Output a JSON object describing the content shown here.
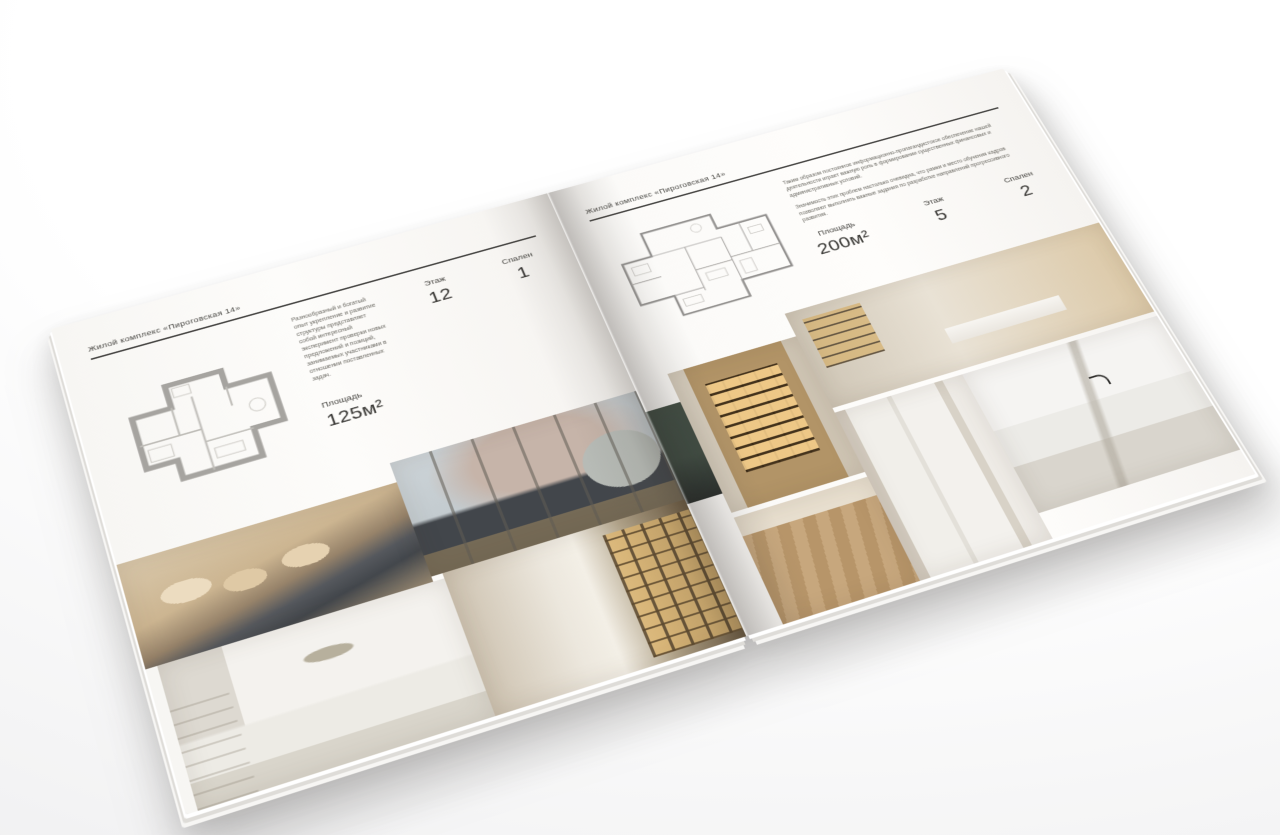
{
  "palette": {
    "page": "#fcfbf9",
    "text": "#3f3e3c",
    "rule": "#454442",
    "wood_accent": "#c2a26c"
  },
  "left_page": {
    "header": "Жилой комплекс «Пироговская 14»",
    "description": "Разнообразный и богатый опыт укрепление и развитие структуры представляет собой интересный эксперимент проверки новых предложений и позиций, занимаемых участниками в отношении поставленных задач.",
    "stats": {
      "area": {
        "label": "Площадь",
        "value": "125м²"
      },
      "floor": {
        "label": "Этаж",
        "value": "12"
      },
      "bedrooms": {
        "label": "Спален",
        "value": "1"
      }
    },
    "photos": [
      "bedroom-beige",
      "living-room-window",
      "bedroom-white",
      "hallway-shelves"
    ]
  },
  "right_page": {
    "header": "Жилой комплекс «Пироговская 14»",
    "paragraphs": [
      "Таким образом постоянное информационно-пропагандистское обеспечение нашей деятельности играет важную роль в формировании существенных финансовых и административных условий.",
      "Значимость этих проблем настолько очевидна, что рамки и место обучения кадров позволяют выполнять важные задания по разработке направлений прогрессивного развития."
    ],
    "stats": {
      "area": {
        "label": "Площадь",
        "value": "200м²"
      },
      "floor": {
        "label": "Этаж",
        "value": "5"
      },
      "bedrooms": {
        "label": "Спален",
        "value": "2"
      }
    },
    "photos": [
      "wardrobe-shelves",
      "home-office",
      "bathroom-marble",
      "corridor-white",
      "wood-floor-hall",
      "dark-console"
    ]
  }
}
